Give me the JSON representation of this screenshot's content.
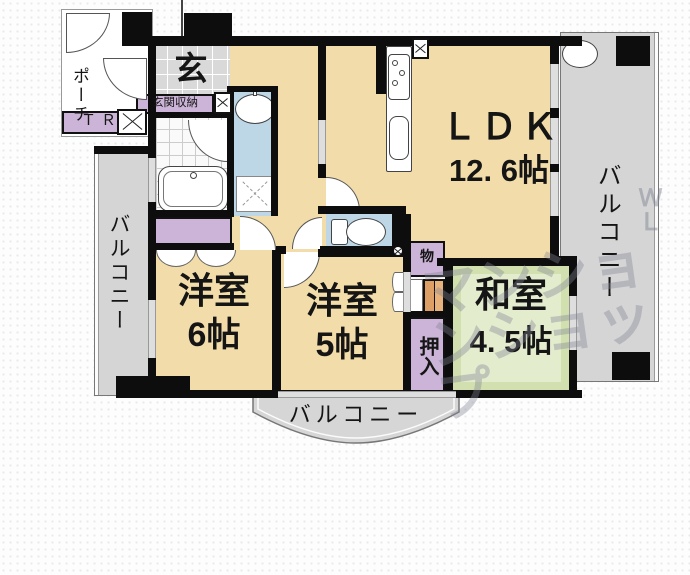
{
  "plan": {
    "rooms": {
      "ldk": {
        "name": "ＬＤＫ",
        "size": "12. 6帖"
      },
      "western6": {
        "name": "洋室",
        "size": "6帖"
      },
      "western5": {
        "name": "洋室",
        "size": "5帖"
      },
      "japanese": {
        "name": "和室",
        "size": "4. 5帖"
      },
      "entrance": {
        "label": "玄"
      },
      "entrance_storage": {
        "label": "玄関収納"
      },
      "porch": {
        "label": "ポーチ"
      },
      "trunk_room": {
        "label": "ＴＲ"
      },
      "oshiire_closet": {
        "label": "押入"
      },
      "storage": {
        "label": "物"
      }
    },
    "balconies": {
      "left": "バルコニー",
      "right": "バルコニー",
      "bottom": "バルコニー"
    },
    "watermark": {
      "main": "マンションショップ",
      "side": "ＷＬ"
    },
    "colors": {
      "room_beige": "#f2ddaa",
      "tatami_green": "#d2dfae",
      "wet_blue": "#bdd7e7",
      "closet_purple": "#ccb4d8",
      "balcony_gray": "#d5d5d5",
      "wall_black": "#0d0d0d",
      "wood_orange": "#dd9f66"
    }
  }
}
